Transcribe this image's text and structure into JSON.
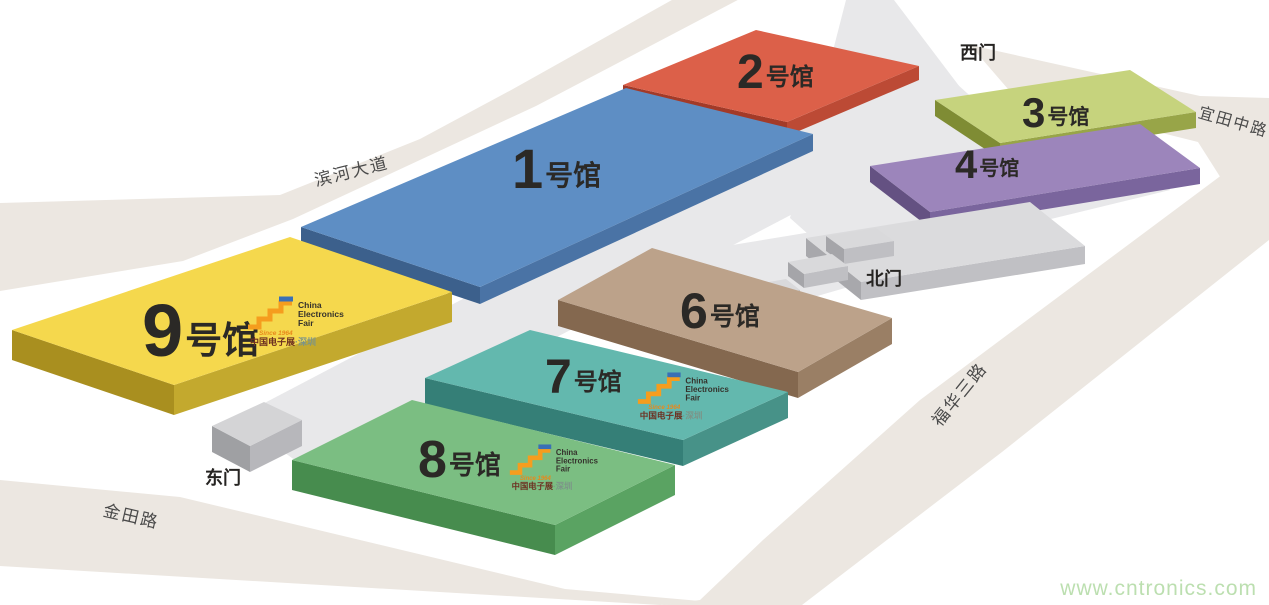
{
  "page": {
    "background": "#FFFFFF",
    "watermark": {
      "text": "www.cntronics.com",
      "color": "#BCDFB0"
    }
  },
  "cef_logo": {
    "since": "Since 1964",
    "line1": "China",
    "line2": "Electronics",
    "line3": "Fair",
    "cn": "中国电子展",
    "city": "·深圳",
    "step_color": "#F59D1E",
    "bar_color": "#3A70B5",
    "since_color": "#E8891B",
    "en_color": "#35322C",
    "cn_color": "#6D3021",
    "city_color": "#7C9488"
  },
  "map": {
    "width": 1269,
    "height": 605,
    "road_fill": "#ECE7E1",
    "flat_fill": "#E8E8EA",
    "road_label_color": "#4A4A4A",
    "gate_label_color": "#262422",
    "hall_label_color": "#2B2926",
    "roads": [
      {
        "id": "road-binhe",
        "name": "滨河大道",
        "polygon": [
          [
            0,
            203
          ],
          [
            280,
            195
          ],
          [
            420,
            139
          ],
          [
            513,
            89
          ],
          [
            704,
            -18
          ],
          [
            772,
            -18
          ],
          [
            536,
            106
          ],
          [
            293,
            219
          ],
          [
            183,
            261
          ],
          [
            0,
            291
          ]
        ],
        "label": {
          "x": 353,
          "y": 177,
          "rot": -14,
          "size": 17
        }
      },
      {
        "id": "road-yitian",
        "name": "宜田中路",
        "polygon": [
          [
            970,
            45
          ],
          [
            1200,
            96
          ],
          [
            1269,
            98
          ],
          [
            1269,
            160
          ],
          [
            1238,
            205
          ],
          [
            1198,
            142
          ],
          [
            1014,
            96
          ]
        ],
        "label": {
          "x": 1232,
          "y": 127,
          "rot": 16,
          "size": 16
        }
      },
      {
        "id": "road-fuhua",
        "name": "福华三路",
        "polygon": [
          [
            700,
            600
          ],
          [
            763,
            540
          ],
          [
            920,
            400
          ],
          [
            1258,
            148
          ],
          [
            1269,
            148
          ],
          [
            1269,
            240
          ],
          [
            1002,
            452
          ],
          [
            802,
            605
          ],
          [
            660,
            605
          ]
        ],
        "label": {
          "x": 964,
          "y": 398,
          "rot": -51,
          "size": 17
        }
      },
      {
        "id": "road-jintian",
        "name": "金田路",
        "polygon": [
          [
            0,
            480
          ],
          [
            180,
            497
          ],
          [
            565,
            589
          ],
          [
            700,
            601
          ],
          [
            660,
            605
          ],
          [
            0,
            566
          ]
        ],
        "label": {
          "x": 130,
          "y": 522,
          "rot": 13,
          "size": 17
        }
      }
    ],
    "flat_areas": [
      {
        "id": "plaza-west-wedge",
        "polygon": [
          [
            846,
            0
          ],
          [
            894,
            0
          ],
          [
            1000,
            140
          ],
          [
            862,
            282
          ],
          [
            790,
            218
          ]
        ]
      },
      {
        "id": "central-corridor",
        "polygon": [
          [
            926,
            56
          ],
          [
            988,
            112
          ],
          [
            306,
            468
          ],
          [
            236,
            418
          ]
        ]
      },
      {
        "id": "platform-strip",
        "polygon": [
          [
            900,
            210
          ],
          [
            1160,
            168
          ],
          [
            1170,
            190
          ],
          [
            915,
            252
          ]
        ]
      },
      {
        "id": "north-gate-platform",
        "polygon": [
          [
            690,
            252
          ],
          [
            920,
            214
          ],
          [
            956,
            256
          ],
          [
            748,
            316
          ]
        ]
      }
    ],
    "blocks": [
      {
        "id": "hall-2",
        "number": "2",
        "suffix": "号馆",
        "height": 14,
        "top": [
          [
            623,
            85
          ],
          [
            756,
            30
          ],
          [
            919,
            66
          ],
          [
            787,
            122
          ]
        ],
        "colors": {
          "top": "#DC6049",
          "left": "#A33A28",
          "right": "#BC4A35"
        },
        "label": {
          "x": 737,
          "y": 88,
          "size": 48
        }
      },
      {
        "id": "hall-3",
        "number": "3",
        "suffix": "号馆",
        "height": 16,
        "top": [
          [
            935,
            100
          ],
          [
            1130,
            70
          ],
          [
            1196,
            112
          ],
          [
            1000,
            143
          ]
        ],
        "colors": {
          "top": "#C6D37D",
          "left": "#7F8C34",
          "right": "#98A548"
        },
        "label": {
          "x": 1022,
          "y": 127,
          "size": 42
        }
      },
      {
        "id": "hall-4",
        "number": "4",
        "suffix": "号馆",
        "height": 16,
        "top": [
          [
            870,
            166
          ],
          [
            1140,
            124
          ],
          [
            1200,
            168
          ],
          [
            930,
            212
          ]
        ],
        "colors": {
          "top": "#9C85BB",
          "left": "#645182",
          "right": "#7A659D"
        },
        "label": {
          "x": 955,
          "y": 178,
          "size": 40
        }
      },
      {
        "id": "gray-building",
        "number": "",
        "suffix": "",
        "height": 18,
        "top": [
          [
            806,
            238
          ],
          [
            1030,
            202
          ],
          [
            1085,
            246
          ],
          [
            861,
            282
          ]
        ],
        "colors": {
          "top": "#DBDBDD",
          "left": "#A8A8AC",
          "right": "#C0C0C4"
        }
      },
      {
        "id": "north-stair-block-1",
        "number": "",
        "suffix": "",
        "height": 15,
        "top": [
          [
            826,
            236
          ],
          [
            876,
            228
          ],
          [
            894,
            241
          ],
          [
            844,
            249
          ]
        ],
        "colors": {
          "top": "#D9D9DB",
          "left": "#A5A5A9",
          "right": "#BFBFC3"
        }
      },
      {
        "id": "north-stair-block-2",
        "number": "",
        "suffix": "",
        "height": 14,
        "top": [
          [
            788,
            262
          ],
          [
            832,
            254
          ],
          [
            848,
            266
          ],
          [
            804,
            274
          ]
        ],
        "colors": {
          "top": "#D9D9DB",
          "left": "#A5A5A9",
          "right": "#BFBFC3"
        }
      },
      {
        "id": "north-stair-block-3",
        "number": "",
        "suffix": "",
        "height": 13,
        "top": [
          [
            746,
            286
          ],
          [
            786,
            279
          ],
          [
            800,
            290
          ],
          [
            760,
            297
          ]
        ],
        "colors": {
          "top": "#D9D9DB",
          "left": "#A5A5A9",
          "right": "#BFBFC3"
        }
      },
      {
        "id": "hall-1",
        "number": "1",
        "suffix": "号馆",
        "height": 17,
        "top": [
          [
            301,
            227
          ],
          [
            626,
            88
          ],
          [
            813,
            134
          ],
          [
            480,
            287
          ]
        ],
        "colors": {
          "top": "#5E8EC4",
          "left": "#3C608C",
          "right": "#4A73A5"
        },
        "label": {
          "x": 512,
          "y": 188,
          "size": 56
        }
      },
      {
        "id": "hall-9",
        "number": "9",
        "suffix": "号馆",
        "height": 30,
        "top": [
          [
            12,
            330
          ],
          [
            290,
            237
          ],
          [
            452,
            292
          ],
          [
            174,
            385
          ]
        ],
        "colors": {
          "top": "#F5D84D",
          "left": "#A98F1F",
          "right": "#C3A92E"
        },
        "label": {
          "x": 142,
          "y": 356,
          "size": 74
        },
        "logo": {
          "x": 246,
          "y": 296,
          "scale": 1
        }
      },
      {
        "id": "hall-6",
        "number": "6",
        "suffix": "号馆",
        "height": 26,
        "top": [
          [
            558,
            300
          ],
          [
            652,
            248
          ],
          [
            892,
            318
          ],
          [
            798,
            372
          ]
        ],
        "colors": {
          "top": "#BCA28A",
          "left": "#84684F",
          "right": "#9A7F65"
        },
        "label": {
          "x": 680,
          "y": 328,
          "size": 50
        }
      },
      {
        "id": "hall-7",
        "number": "7",
        "suffix": "号馆",
        "height": 26,
        "top": [
          [
            425,
            378
          ],
          [
            530,
            330
          ],
          [
            788,
            392
          ],
          [
            683,
            440
          ]
        ],
        "colors": {
          "top": "#63B8AE",
          "left": "#357F77",
          "right": "#479288"
        },
        "label": {
          "x": 545,
          "y": 393,
          "size": 48
        },
        "logo": {
          "x": 636,
          "y": 372,
          "scale": 0.95
        }
      },
      {
        "id": "hall-8",
        "number": "8",
        "suffix": "号馆",
        "height": 30,
        "top": [
          [
            292,
            460
          ],
          [
            412,
            400
          ],
          [
            675,
            465
          ],
          [
            555,
            525
          ]
        ],
        "colors": {
          "top": "#7BBE82",
          "left": "#478C4E",
          "right": "#5AA362"
        },
        "label": {
          "x": 418,
          "y": 477,
          "size": 52
        },
        "logo": {
          "x": 508,
          "y": 444,
          "scale": 0.92
        }
      },
      {
        "id": "east-gate-block",
        "number": "",
        "suffix": "",
        "height": 26,
        "top": [
          [
            212,
            426
          ],
          [
            264,
            402
          ],
          [
            302,
            420
          ],
          [
            250,
            446
          ]
        ],
        "colors": {
          "top": "#D4D4D6",
          "left": "#9FA0A3",
          "right": "#B7B7BB"
        }
      }
    ],
    "gates": [
      {
        "id": "gate-west",
        "name": "西门",
        "x": 978,
        "y": 59,
        "size": 18
      },
      {
        "id": "gate-north",
        "name": "北门",
        "x": 884,
        "y": 285,
        "size": 18
      },
      {
        "id": "gate-east",
        "name": "东门",
        "x": 223,
        "y": 484,
        "size": 18
      }
    ]
  }
}
